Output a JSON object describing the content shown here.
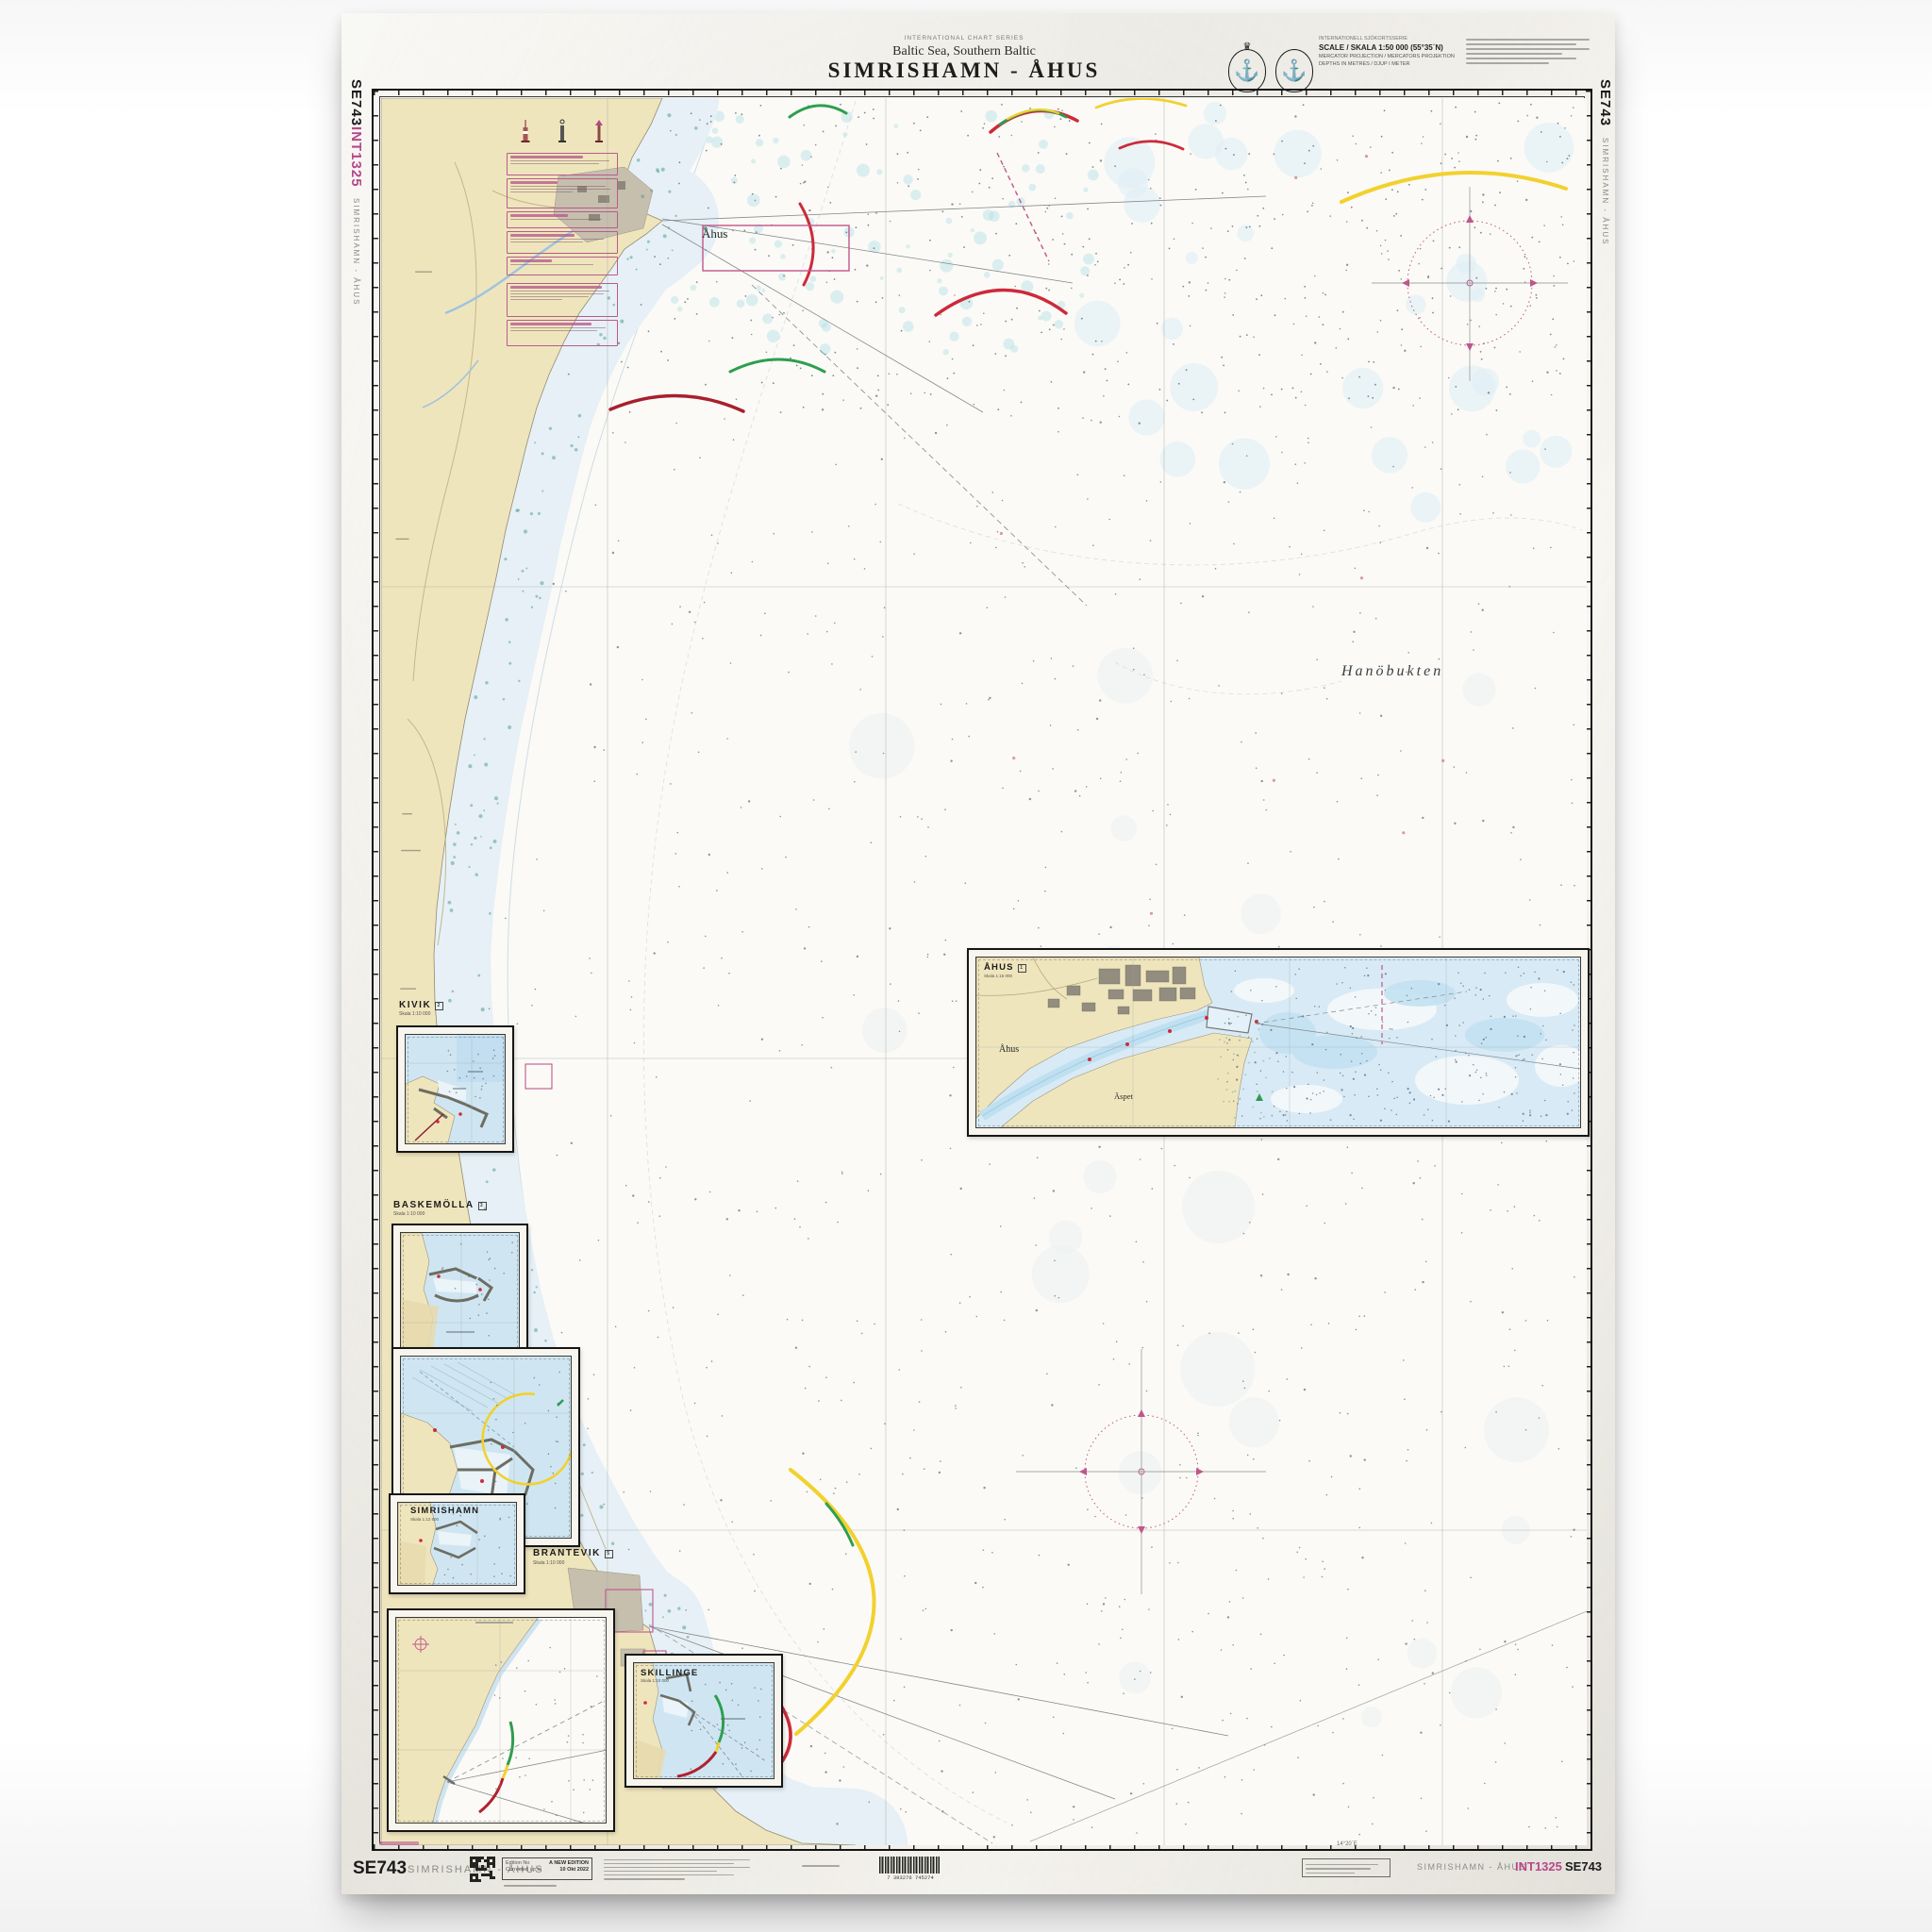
{
  "header": {
    "series": "INTERNATIONAL CHART SERIES",
    "region": "Baltic Sea, Southern Baltic",
    "title": "SIMRISHAMN - ÅHUS"
  },
  "scale_block": {
    "l1": "INTERNATIONELL SJÖKORTSSERIE",
    "scale": "SCALE / SKALA 1:50 000 (55°35´N)",
    "l3": "MERCATOR PROJECTION / MERCATORS PROJEKTION",
    "l4": "DEPTHS IN METRES / DJUP I METER"
  },
  "edges": {
    "left_no": "SE743",
    "left_int": "INT1325",
    "left_title": "SIMRISHAMN - ÅHUS",
    "right_no": "SE743",
    "right_title": "SIMRISHAMN - ÅHUS"
  },
  "map_labels": {
    "bay": "Hanöbukten",
    "town": "Åhus",
    "aspet": "Äspet"
  },
  "insets": [
    {
      "id": "kivik",
      "title": "KIVIK",
      "scale": "Skala 1:10 000",
      "ref": "2"
    },
    {
      "id": "baskemolla",
      "title": "BASKEMÖLLA",
      "scale": "Skala 1:10 000",
      "ref": "3"
    },
    {
      "id": "simrishamn",
      "title": "SIMRISHAMN",
      "scale": "Skala 1:12 500",
      "ref": "4"
    },
    {
      "id": "brantevik",
      "title": "BRANTEVIK",
      "scale": "Skala 1:10 000",
      "ref": "5"
    },
    {
      "id": "skillinge",
      "title": "SKILLINGE",
      "scale": "Skala 1:10 000",
      "ref": "6"
    },
    {
      "id": "ahus",
      "title": "ÅHUS",
      "scale": "Skala 1:15 000",
      "ref": "1"
    }
  ],
  "bottom": {
    "chart_no": "SE743",
    "title": "SIMRISHAMN - ÅHUS",
    "ed_label1": "Edition No",
    "ed_label2": "Corrected up to",
    "ed_val1": "A NEW EDITION",
    "ed_val2": "10 Okt 2022",
    "barcode": "7 393276 745274",
    "lon_label": "14°20´E",
    "right_title": "SIMRISHAMN - ÅHUS",
    "right_int": "INT1325",
    "right_no": "SE743"
  },
  "colors": {
    "land": "#efe5bd",
    "shallow": "#d3e6f1",
    "magenta": "#c0568b",
    "red": "#cc2a3a",
    "green": "#2e9e4f",
    "yellow": "#f2d12e"
  }
}
